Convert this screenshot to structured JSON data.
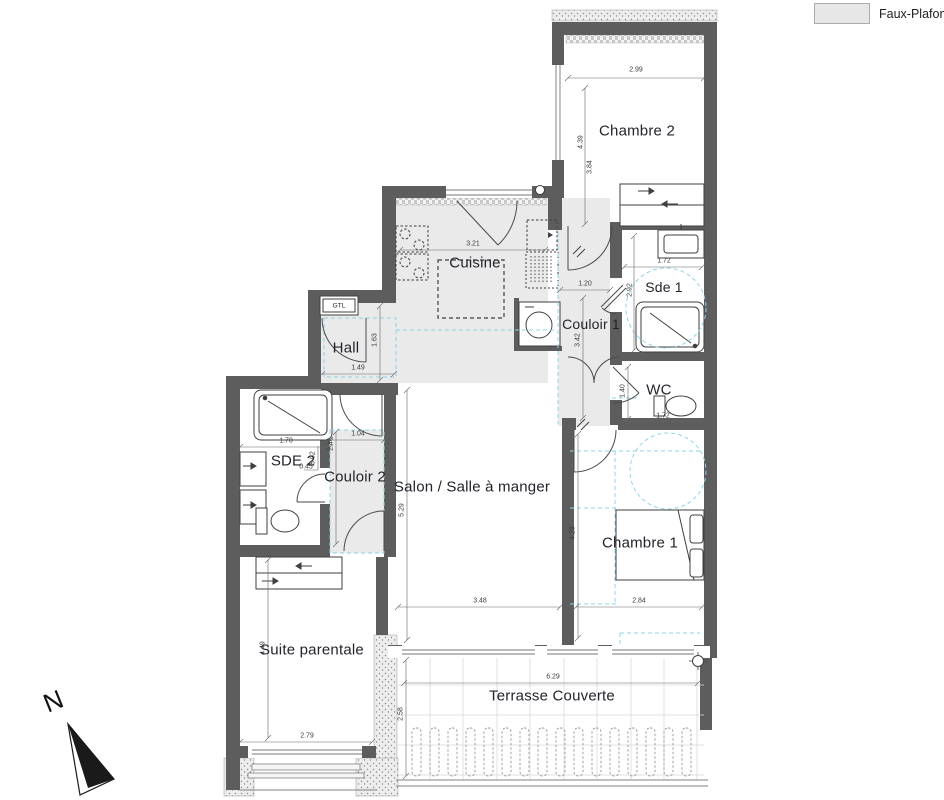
{
  "legend": {
    "faux_plafond_label": "Faux-Plafond",
    "swatch_color": "#e7e7e7"
  },
  "compass": {
    "north_label": "N"
  },
  "colors": {
    "wall": "#5d5d5d",
    "shaded_room": "#eaeaea",
    "dashed_accent": "#8fd3e8",
    "line": "#3f3f3f"
  },
  "rooms": {
    "chambre2": {
      "label": "Chambre 2"
    },
    "cuisine": {
      "label": "Cuisine"
    },
    "sde1": {
      "label": "Sde 1"
    },
    "couloir1": {
      "label": "Couloir 1"
    },
    "hall": {
      "label": "Hall"
    },
    "gtl": {
      "label": "GTL"
    },
    "wc": {
      "label": "WC"
    },
    "sde2": {
      "label": "SDE 2"
    },
    "couloir2": {
      "label": "Couloir 2"
    },
    "salon": {
      "label": "Salon / Salle à manger"
    },
    "chambre1": {
      "label": "Chambre 1"
    },
    "suite_parentale": {
      "label": "Suite parentale"
    },
    "terrasse": {
      "label": "Terrasse Couverte"
    }
  },
  "dimensions": {
    "chambre2_width": "2.99",
    "chambre2_height": "4.39",
    "chambre2_height_2": "3.84",
    "cuisine_width": "3.21",
    "couloir1_width": "1.20",
    "couloir1_length": "3.42",
    "sde1_width": "1.72",
    "sde1_height": "2.92",
    "hall_width": "1.49",
    "hall_height": "1.63",
    "wc_height": "1.40",
    "wc_width": "1.72",
    "sde2_width": "1.70",
    "couloir2_width": "1.04",
    "couloir2_height": "2.46",
    "couloir2_depth": "3.02",
    "couloir2_offset": "0.45",
    "salon_height": "5.29",
    "salon_width": "3.48",
    "chambre1_height": "4.29",
    "chambre1_width": "2.84",
    "suite_height": "4.49",
    "suite_width": "2.79",
    "terrasse_width": "6.29",
    "terrasse_height": "2.58"
  }
}
